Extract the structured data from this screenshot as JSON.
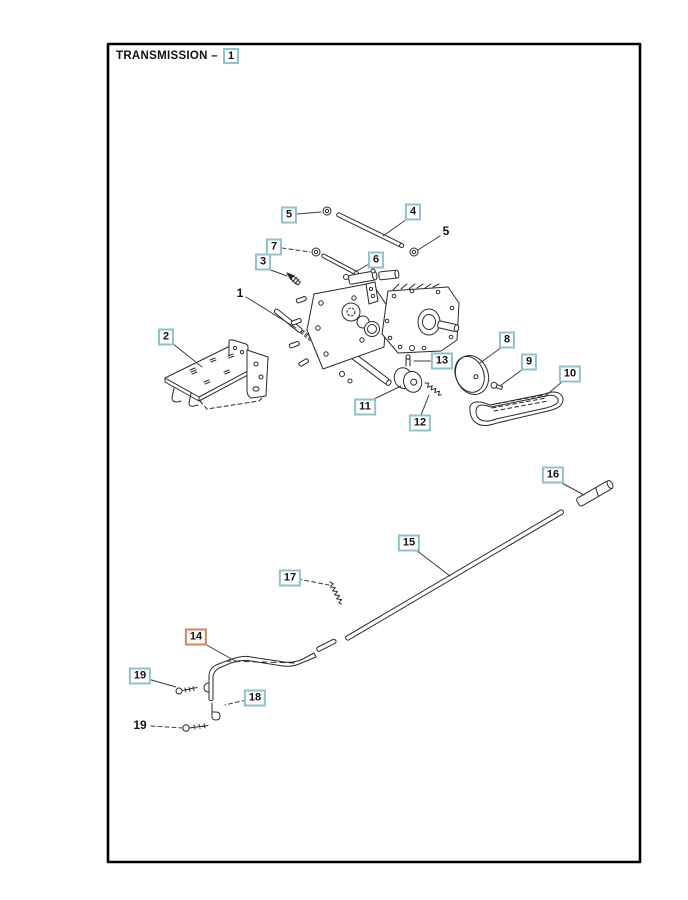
{
  "page": {
    "title": "TRANSMISSION –",
    "title_ref": "1"
  },
  "colors": {
    "callout_border": "#8ec3cc",
    "callout_highlight_border": "#cb8a64",
    "line_art": "#2b2b2b"
  },
  "diagram": {
    "description": "Exploded parts view of transmission assembly with numbered callouts",
    "callouts": [
      {
        "label": "5",
        "x": 289,
        "y": 215,
        "boxed": true,
        "highlighted": false
      },
      {
        "label": "4",
        "x": 413,
        "y": 212,
        "boxed": true,
        "highlighted": false
      },
      {
        "label": "5",
        "x": 446,
        "y": 231,
        "boxed": false,
        "highlighted": false
      },
      {
        "label": "7",
        "x": 274,
        "y": 247,
        "boxed": true,
        "highlighted": false
      },
      {
        "label": "3",
        "x": 263,
        "y": 262,
        "boxed": true,
        "highlighted": false
      },
      {
        "label": "6",
        "x": 376,
        "y": 260,
        "boxed": true,
        "highlighted": false
      },
      {
        "label": "1",
        "x": 240,
        "y": 293,
        "boxed": false,
        "highlighted": false
      },
      {
        "label": "2",
        "x": 166,
        "y": 337,
        "boxed": true,
        "highlighted": false
      },
      {
        "label": "8",
        "x": 507,
        "y": 340,
        "boxed": true,
        "highlighted": false
      },
      {
        "label": "13",
        "x": 442,
        "y": 361,
        "boxed": true,
        "highlighted": false
      },
      {
        "label": "9",
        "x": 529,
        "y": 362,
        "boxed": true,
        "highlighted": false
      },
      {
        "label": "10",
        "x": 570,
        "y": 374,
        "boxed": true,
        "highlighted": false
      },
      {
        "label": "11",
        "x": 365,
        "y": 407,
        "boxed": true,
        "highlighted": false
      },
      {
        "label": "12",
        "x": 420,
        "y": 423,
        "boxed": true,
        "highlighted": false
      },
      {
        "label": "16",
        "x": 553,
        "y": 475,
        "boxed": true,
        "highlighted": false
      },
      {
        "label": "15",
        "x": 409,
        "y": 543,
        "boxed": true,
        "highlighted": false
      },
      {
        "label": "17",
        "x": 290,
        "y": 578,
        "boxed": true,
        "highlighted": false
      },
      {
        "label": "14",
        "x": 196,
        "y": 637,
        "boxed": true,
        "highlighted": true
      },
      {
        "label": "19",
        "x": 140,
        "y": 676,
        "boxed": true,
        "highlighted": false
      },
      {
        "label": "18",
        "x": 255,
        "y": 698,
        "boxed": true,
        "highlighted": false
      },
      {
        "label": "19",
        "x": 140,
        "y": 725,
        "boxed": false,
        "highlighted": false
      }
    ]
  }
}
